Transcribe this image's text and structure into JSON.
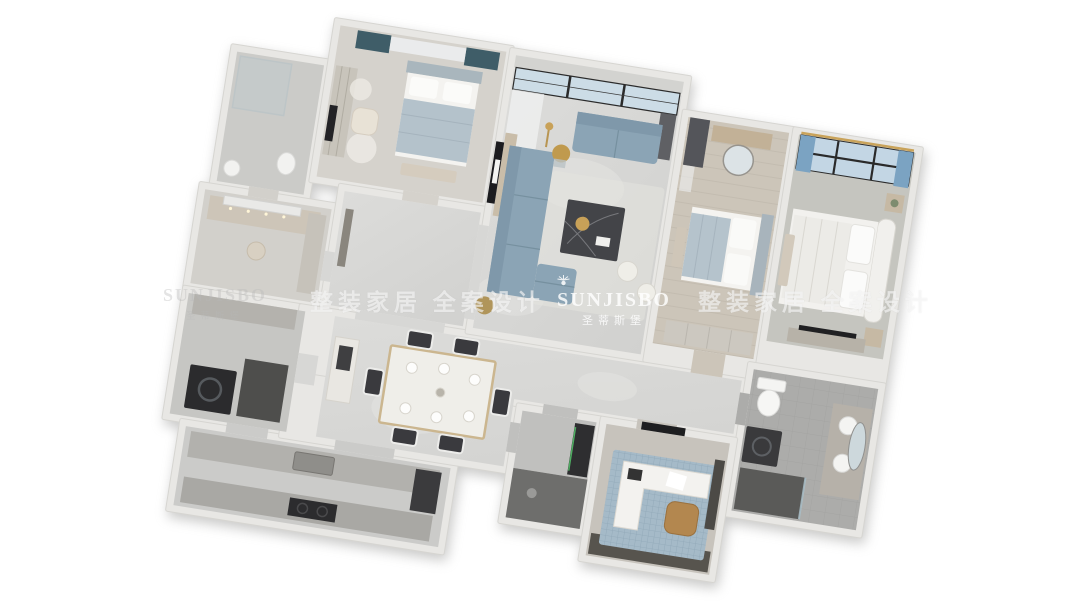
{
  "watermark_band": {
    "left_logo": {
      "latin": "SUNJISBO",
      "chinese": "圣蒂斯堡"
    },
    "left_slogan": "整装家居 全案设计",
    "center_logo": {
      "icon": "sunburst",
      "latin": "SUNJISBO",
      "chinese": "圣蒂斯堡"
    },
    "right_slogan": "整装家居 全案设计"
  },
  "palette": {
    "background": "#ffffff",
    "wall": "#e8e7e4",
    "marble_floor": "#d7d7d5",
    "sofa_blue": "#8ba4b5",
    "curtain_teal": "#3f5d68",
    "window_glass_blue": "#c3d6e4",
    "curtain_accent_blue": "#7ba3c2",
    "accent_gold": "#c8a158",
    "appliance_dark": "#2e2e30",
    "rug_blue": "#a5bac8",
    "chair_tan": "#b3874f"
  },
  "scene": {
    "type": "3d-apartment-floor-plan-render",
    "view": "top-down isometric, plan rotated clockwise on white background",
    "rooms": [
      {
        "name": "bedroom-2",
        "furniture": [
          "double-bed",
          "wardrobe",
          "teal-curtains",
          "lounge-chair",
          "wall-tv"
        ]
      },
      {
        "name": "bathroom-1",
        "furniture": [
          "glass-shower",
          "toilet",
          "sink"
        ]
      },
      {
        "name": "cloakroom-vanity",
        "furniture": [
          "makeup-vanity",
          "lit-mirror",
          "stool",
          "cabinet"
        ]
      },
      {
        "name": "foyer",
        "furniture": [
          "console"
        ]
      },
      {
        "name": "living-room",
        "furniture": [
          "l-shaped-sofa",
          "loveseat",
          "marble-coffee-table",
          "poufs",
          "tv-wall",
          "balcony-sliding-doors",
          "sheer-curtains",
          "gold-plant",
          "floor-lamp"
        ]
      },
      {
        "name": "bedroom-3",
        "furniture": [
          "double-bed",
          "dresser",
          "round-mirror",
          "wardrobe",
          "dark-curtains"
        ]
      },
      {
        "name": "master-bedroom",
        "furniture": [
          "double-bed",
          "curved-headboard",
          "nightstands",
          "picture-window",
          "blue-curtains",
          "tv-cabinet",
          "bench"
        ]
      },
      {
        "name": "dining-room",
        "furniture": [
          "dining-table",
          "six-chairs",
          "sideboard",
          "tableware"
        ]
      },
      {
        "name": "laundry-room",
        "furniture": [
          "washing-machine",
          "counters"
        ]
      },
      {
        "name": "kitchen",
        "furniture": [
          "sink-counter",
          "stove-counter",
          "fridge",
          "cabinets"
        ]
      },
      {
        "name": "guest-bathroom",
        "furniture": [
          "dark-tile-floor",
          "mirror-cabinet"
        ]
      },
      {
        "name": "study",
        "furniture": [
          "l-desk",
          "tan-chair",
          "mosaic-rug",
          "wall-tv",
          "bookshelf"
        ]
      },
      {
        "name": "master-bathroom",
        "furniture": [
          "toilet",
          "washing-machine",
          "vanity-basins",
          "oval-mirror",
          "dark-shower"
        ]
      }
    ]
  }
}
